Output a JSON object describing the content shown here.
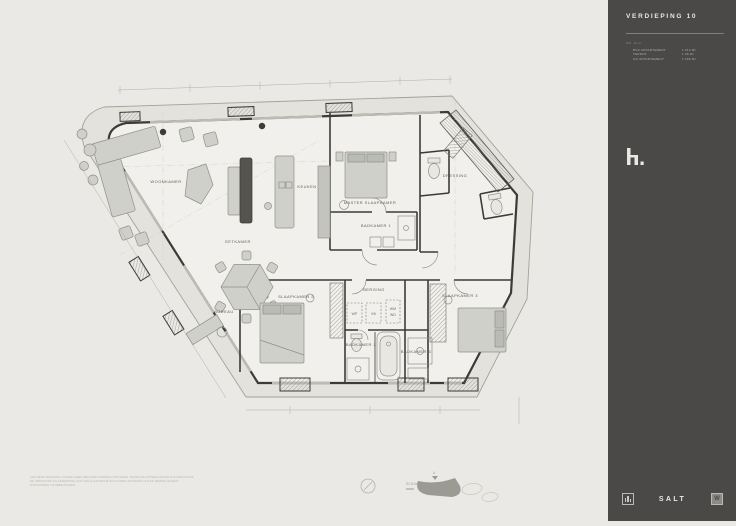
{
  "sheet": {
    "floor_title": "VERDIEPING 10"
  },
  "sidebar": {
    "title": "VERDIEPING 10",
    "info": {
      "number": "NR. 10.2",
      "rows": [
        {
          "label": "BVO APPARTEMENT",
          "value": "± 214 M²"
        },
        {
          "label": "TERRAS",
          "value": "± 28 M²"
        },
        {
          "label": "GO APPARTEMENT",
          "value": "± 186 M²"
        }
      ]
    },
    "brand": {
      "monogram": "h."
    },
    "footer": {
      "wordmark": "SALT",
      "right_monogram": "W"
    }
  },
  "plan": {
    "labels": {
      "woonkamer": "WOONKAMER",
      "eetkamer": "EETKAMER",
      "keuken": "KEUKEN",
      "master": "MASTER SLAAPKAMER",
      "badkamer1": "BADKAMER 1",
      "dressing": "DRESSING",
      "slaapkamer2": "SLAAPKAMER 2",
      "slaapkamer3": "SLAAPKAMER 3",
      "berging": "BERGING",
      "bureau": "BUREAU",
      "wp": "WP",
      "vb": "VB",
      "wm": "WM",
      "wd": "WD",
      "badkamer2": "BADKAMER 2",
      "badkamer3": "BADKAMER 3"
    },
    "legend": {
      "scale": "SCHAAL 1:100",
      "marker": "A"
    },
    "disclaimer": [
      "AAN DEZE TEKENING KUNNEN GEEN RECHTEN WORDEN ONTLEEND. MATEN EN OPPERVLAKTEN ZIJN INDICATIEF.",
      "DE INRICHTING EN AFWERKING ZIJN TER ILLUSTRATIE EN KUNNEN AFWIJKEN VAN DE WERKELIJKHEID.",
      "WIJZIGINGEN VOORBEHOUDEN."
    ]
  },
  "colors": {
    "background": "#eae9e5",
    "sidebar": "#4a4947",
    "wall": "#3c3b38",
    "terrace": "#e3e2dd",
    "interior": "#f1f0ec",
    "furniture": "#ced0c9"
  }
}
